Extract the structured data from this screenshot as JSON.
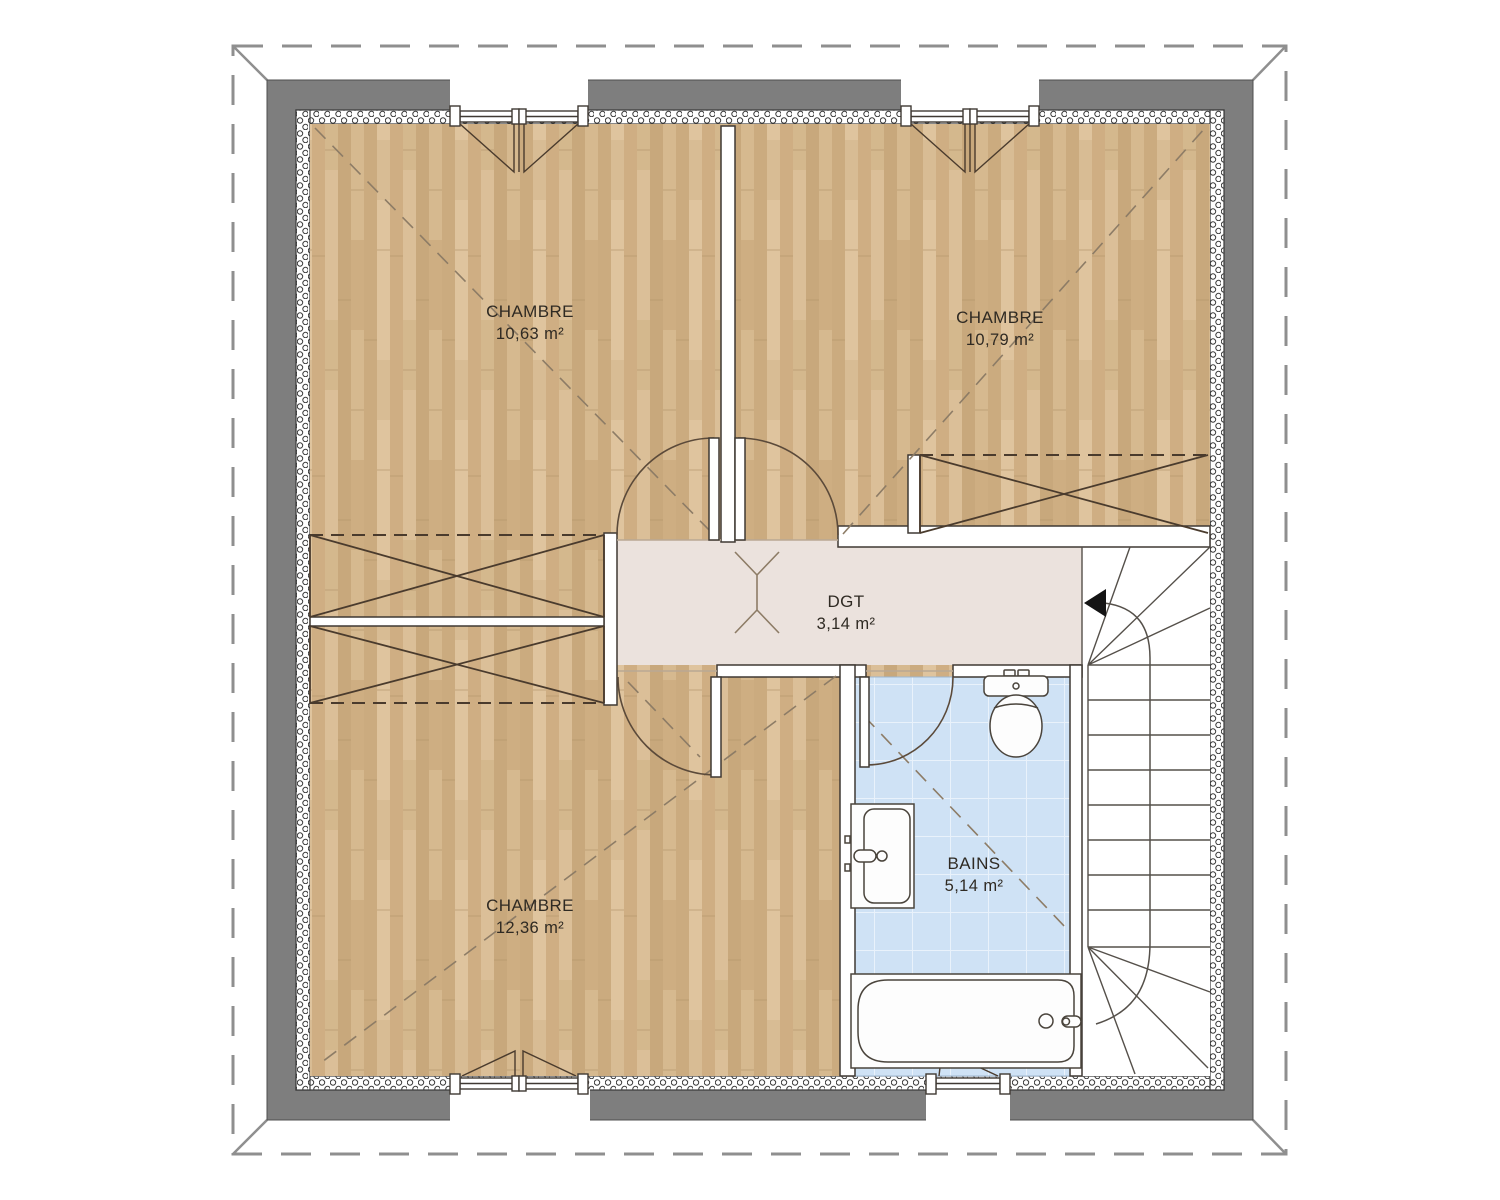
{
  "plan_type": "floor-plan-upper-storey",
  "rooms": [
    {
      "name": "CHAMBRE",
      "area": "10,63 m²"
    },
    {
      "name": "CHAMBRE",
      "area": "10,79 m²"
    },
    {
      "name": "DGT",
      "area": "3,14 m²"
    },
    {
      "name": "BAINS",
      "area": "5,14 m²"
    },
    {
      "name": "CHAMBRE",
      "area": "12,36 m²"
    }
  ],
  "fixtures": {
    "bathroom": [
      "toilet-icon",
      "sink-icon",
      "bathtub-icon"
    ],
    "stairs": {
      "type": "winder-staircase",
      "direction_arrow": "left"
    },
    "windows": 4,
    "doors": 4,
    "low_ceiling_zones": 3
  },
  "colors": {
    "background": "#ffffff",
    "wall_gray": "#7e7e7e",
    "wood_floor": "#d2b288",
    "hallway_floor": "#ebe2dd",
    "bathroom_tile": "#cfe2f5",
    "line_dark": "#3f3933",
    "roof_dash_gray": "#8f8f8f",
    "arrow_black": "#141414"
  }
}
